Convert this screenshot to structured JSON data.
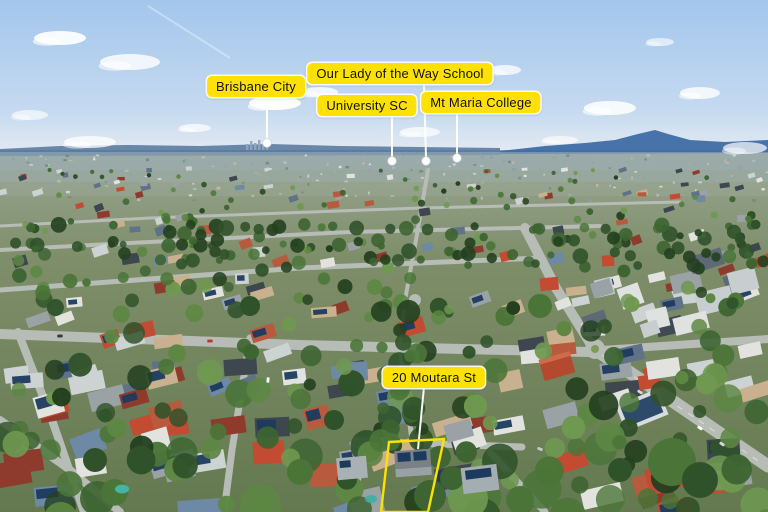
{
  "style": {
    "label_background": "#ffe100",
    "label_text_color": "#111111",
    "pointer_line_color": "#ffffff",
    "outline_color": "#ffe100"
  },
  "palette": {
    "sky_top": "#a3c6ec",
    "sky_mid": "#c6daf0",
    "sky_horizon": "#e9edf2",
    "ridge": "#3e6da4",
    "ridge_far": "#54769d",
    "ground_far": "#9aa694",
    "ground_mid": "#7e8e6a",
    "ground_near": "#647950",
    "road": "#b7bcb6",
    "solar": "#1c3a5e",
    "pool": "#45b7ae",
    "roofs": [
      "#cdd2d3",
      "#e2e3df",
      "#9aa2a6",
      "#5f7287",
      "#b85a3e",
      "#c24b32",
      "#3e4750",
      "#6d89a5",
      "#c9b18f",
      "#8e3b2e"
    ],
    "trees": [
      "#24401f",
      "#30522a",
      "#3d6431",
      "#4b7538",
      "#5d8743",
      "#6f9850"
    ]
  },
  "annotations": {
    "labels": [
      {
        "id": "brisbane-city",
        "text": "Brisbane City",
        "box": {
          "cx": 256,
          "y": 76
        },
        "line": {
          "x1": 267,
          "y1": 96,
          "x2": 267,
          "y2": 139
        },
        "dot": {
          "x": 267,
          "y": 143
        }
      },
      {
        "id": "our-lady-of-the-way-school",
        "text": "Our Lady of the Way School",
        "box": {
          "cx": 400,
          "y": 63
        },
        "line": {
          "x1": 424,
          "y1": 85,
          "x2": 426,
          "y2": 157
        },
        "dot": {
          "x": 426,
          "y": 161
        }
      },
      {
        "id": "university-sc",
        "text": "University SC",
        "box": {
          "cx": 367,
          "y": 95
        },
        "line": {
          "x1": 392,
          "y1": 115,
          "x2": 392,
          "y2": 157
        },
        "dot": {
          "x": 392,
          "y": 161
        }
      },
      {
        "id": "mt-maria-college",
        "text": "Mt Maria College",
        "box": {
          "cx": 481,
          "y": 92
        },
        "line": {
          "x1": 457,
          "y1": 112,
          "x2": 457,
          "y2": 154
        },
        "dot": {
          "x": 457,
          "y": 158
        }
      },
      {
        "id": "property-address",
        "text": "20 Moutara St",
        "box": {
          "cx": 434,
          "y": 367
        },
        "line": {
          "x1": 424,
          "y1": 387,
          "x2": 418,
          "y2": 449
        },
        "dot": null
      }
    ],
    "property_outline": {
      "points": [
        [
          389,
          442
        ],
        [
          444,
          439
        ],
        [
          428,
          512
        ],
        [
          381,
          512
        ]
      ]
    }
  }
}
